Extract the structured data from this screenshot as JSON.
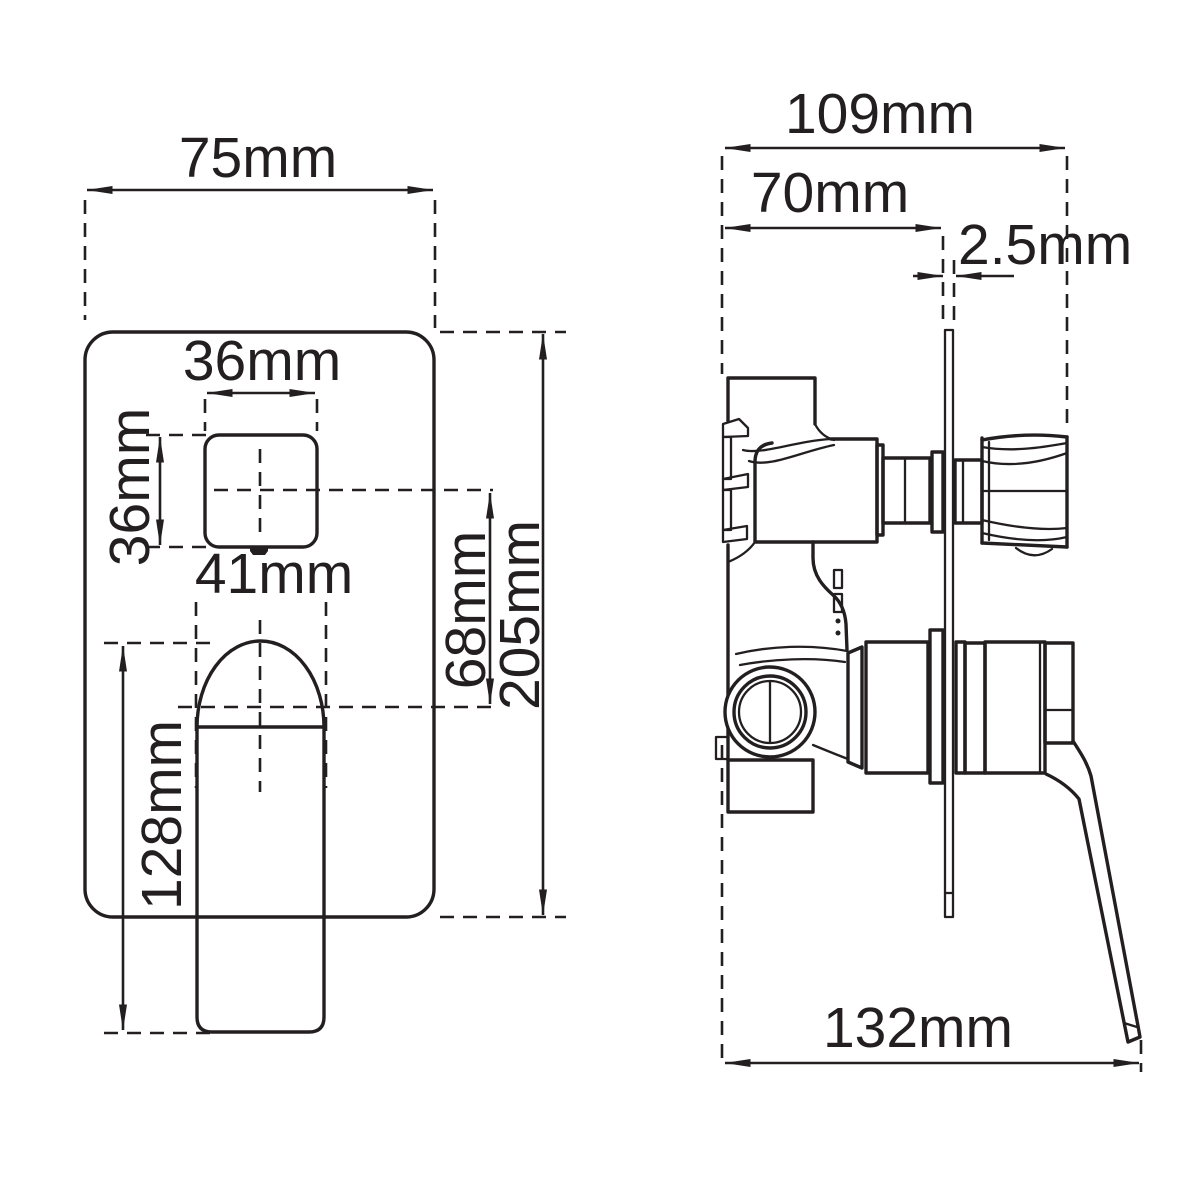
{
  "drawing": {
    "kind": "technical dimension drawing",
    "subject": "concealed shower mixer valve with diverter",
    "views": [
      "front view of wall plate with diverter button and lever",
      "side profile view of valve body, wall plate, diverter knob and lever"
    ],
    "unit": "mm"
  },
  "labels": {
    "front_plate_width": "75mm",
    "button_width": "36mm",
    "button_height": "36mm",
    "lever_width": "41mm",
    "center_offset": "68mm",
    "plate_height": "205mm",
    "lever_length": "128mm",
    "total_depth": "109mm",
    "rough_in_depth": "70mm",
    "plate_thickness": "2.5mm",
    "handle_reach": "132mm"
  },
  "colors": {
    "ink": "#231f20",
    "background": "#ffffff"
  }
}
